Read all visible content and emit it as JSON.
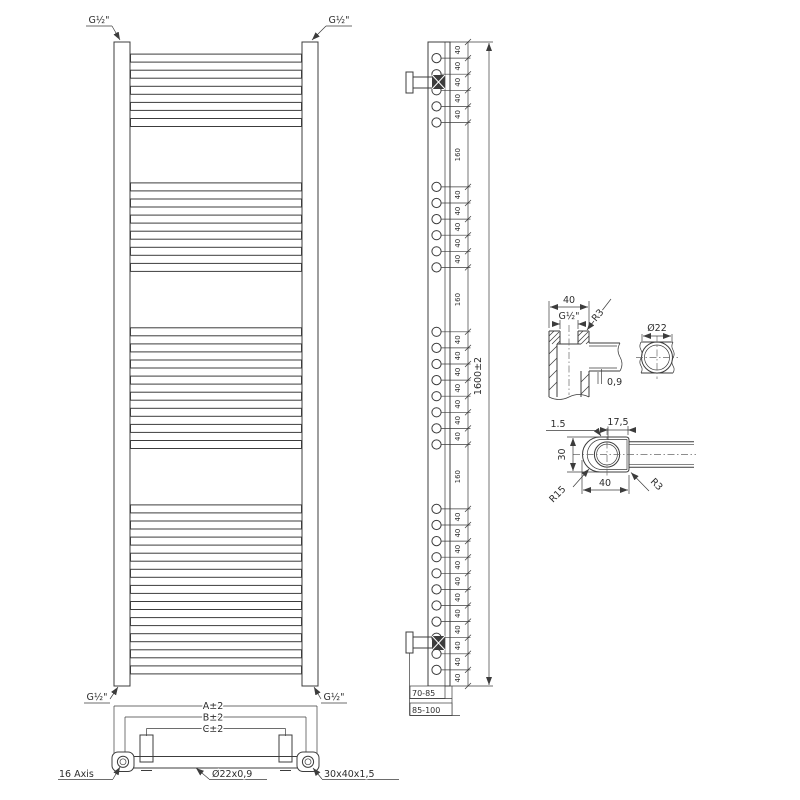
{
  "front_view": {
    "connection_label": "G½\""
  },
  "side_view": {
    "dimension_chain": [
      40,
      40,
      40,
      40,
      40,
      160,
      40,
      40,
      40,
      40,
      40,
      160,
      40,
      40,
      40,
      40,
      40,
      40,
      40,
      160,
      40,
      40,
      40,
      40,
      40,
      40,
      40,
      40,
      40,
      40,
      40
    ],
    "overall_height": "1600±2",
    "bracket_range_near": "70-85",
    "bracket_range_far": "85-100"
  },
  "bottom_view": {
    "width_outer": "A±2",
    "width_mid": "B±2",
    "width_inner": "C±2",
    "axis_note": "16 Axis",
    "tube_spec": "Ø22x0,9",
    "profile_spec": "30x40x1,5"
  },
  "detail_top_connection": {
    "width": "40",
    "thread": "G½\"",
    "corner_radius": "R3",
    "tube_diameter": "Ø22",
    "tube_wall": "0,9"
  },
  "detail_rail_profile": {
    "wall": "1.5",
    "tube_offset": "17,5",
    "depth": "30",
    "radius_front": "R15",
    "width": "40",
    "radius_back": "R3"
  }
}
